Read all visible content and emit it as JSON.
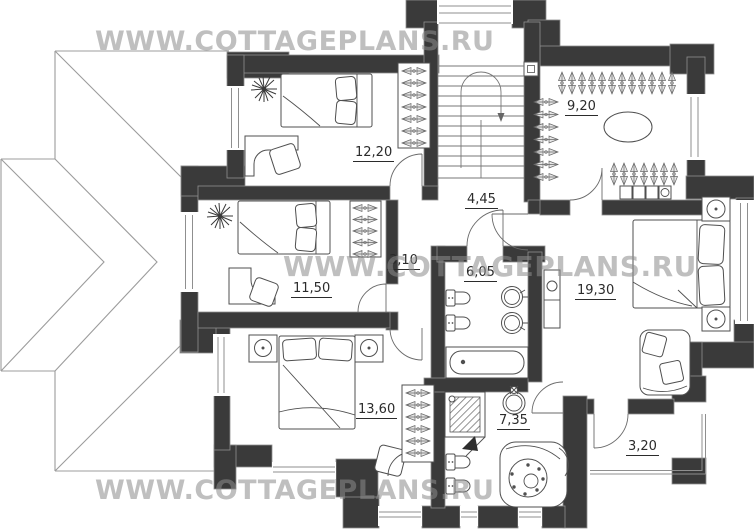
{
  "site_watermark": {
    "text": "WWW.COTTAGEPLANS.RU"
  },
  "rooms": {
    "bedroom_1": {
      "area_m2": "12,20"
    },
    "bedroom_2": {
      "area_m2": "11,50"
    },
    "bedroom_3": {
      "area_m2": "13,60"
    },
    "hall_stairs": {
      "area_m2": "4,45"
    },
    "corridor": {
      "area_m2": "3,10"
    },
    "bathroom": {
      "area_m2": "6,05"
    },
    "wardrobe": {
      "area_m2": "9,20"
    },
    "master_bedroom": {
      "area_m2": "19,30"
    },
    "master_bathroom": {
      "area_m2": "7,35"
    },
    "balcony": {
      "area_m2": "3,20"
    }
  },
  "colors": {
    "wall": "#3a3a3a",
    "wall_outline": "#8f8f8f",
    "furniture_line": "#4f4f4f",
    "roof_line": "#9c9c9c",
    "label_text": "#2b2b2b",
    "watermark": "#8c8c8c"
  }
}
